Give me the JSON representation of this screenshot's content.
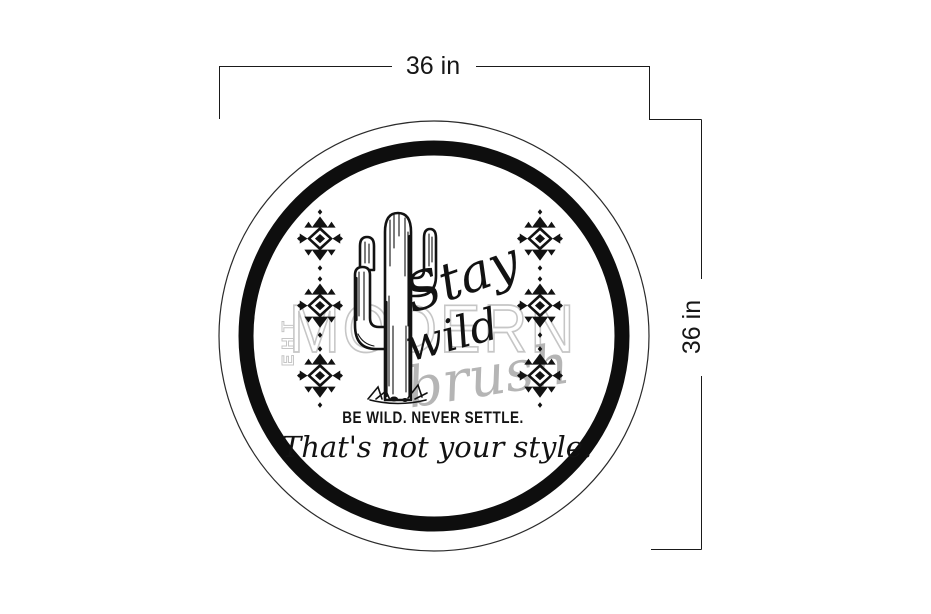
{
  "dimension_annotations": {
    "width_label": "36 in",
    "height_label": "36 in"
  },
  "sign": {
    "shape": "round-circle-sign",
    "script_line1": "Stay",
    "script_line2": "wild",
    "tagline": "BE WILD. NEVER SETTLE.",
    "script_tagline": "That's not your style.",
    "illustration": "saguaro-cactus",
    "motif": "aztec-diamond",
    "motif_columns": 2,
    "motifs_per_column": 3
  },
  "watermark": {
    "the": "THE",
    "the_letters": [
      "T",
      "H",
      "E"
    ],
    "modern": "MODERN",
    "brush": "brush"
  },
  "colors": {
    "ink": "#121212",
    "ring": "#0e0e0e",
    "dimension_line": "#1a1a1a",
    "watermark_outline": "#c6c6c6",
    "watermark_script": "#b5b5b5",
    "background": "#ffffff"
  }
}
